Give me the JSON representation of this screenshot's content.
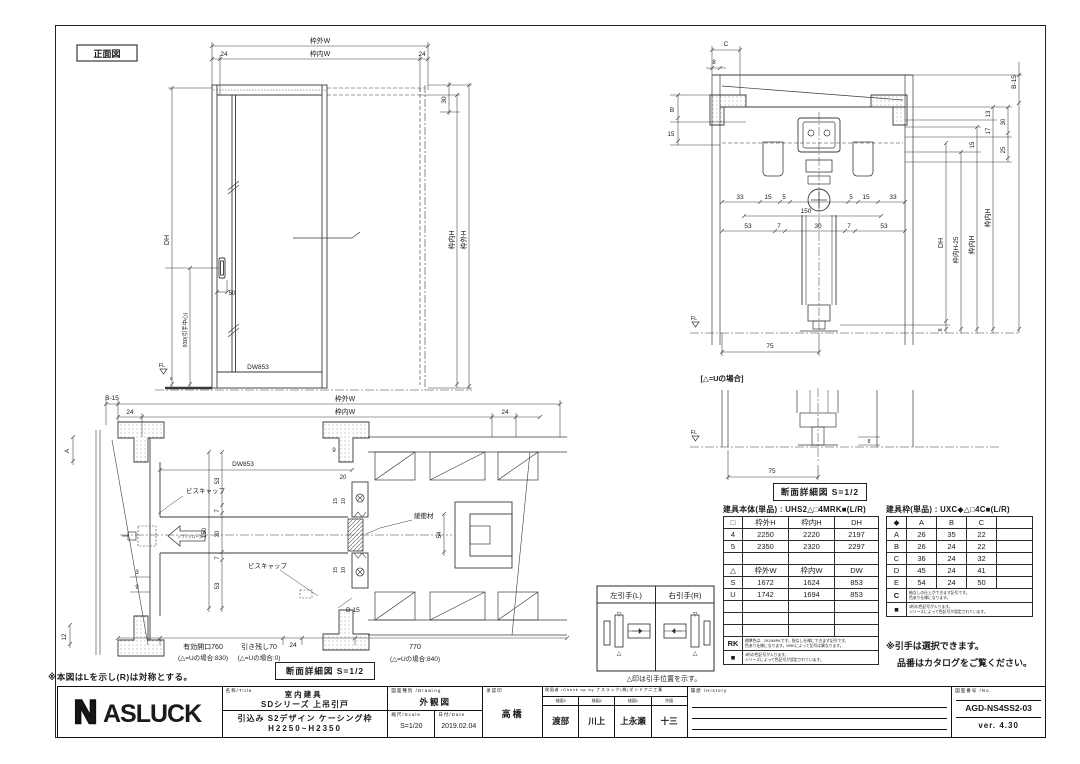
{
  "colors": {
    "line": "#3a3a3a",
    "text": "#1a1a1a",
    "frame": "#222222"
  },
  "front_view": {
    "label": "正面図",
    "dim_outer_w": "枠外W",
    "dim_inner_w": "枠内W",
    "d24_l": "24",
    "d24_r": "24",
    "dh": "DH",
    "handle_center": "930(引手中心)",
    "d50": "50",
    "dw": "DW853",
    "fl": "FL",
    "d8": "8",
    "d30": "30",
    "inner_h": "枠内H",
    "outer_h": "枠外H"
  },
  "plan_view": {
    "b15_l": "B-15",
    "outer_w": "枠外W",
    "inner_w": "枠内W",
    "d24_l": "24",
    "d24_r": "24",
    "d24_b": "24",
    "a": "A",
    "dw": "DW853",
    "d9t": "9",
    "d20": "20",
    "d53a": "53",
    "d7a": "7",
    "d150": "150",
    "d30": "30",
    "d7b": "7",
    "d53b": "53",
    "d15a": "15",
    "d10a": "10",
    "d15b": "15",
    "d10b": "10",
    "d3": "3",
    "d9s": "9",
    "d12": "12",
    "screw_cap": "ビスキャップ",
    "soft_close": "ソフトクローズ",
    "cushion": "緩衝材",
    "d54": "54",
    "b15_r": "B-15",
    "open1": "有効開口760",
    "open1u": "(△=Uの場合:830)",
    "rem": "引き残し70",
    "remu": "(△=Uの場合:0)",
    "d770": "770",
    "d770u": "(△=Uの場合:840)"
  },
  "section_view": {
    "c": "C",
    "d8t": "8",
    "b": "B",
    "d15l": "15",
    "d33a": "33",
    "d15a": "15",
    "d5a": "5",
    "d5b": "5",
    "d15b": "15",
    "d33b": "33",
    "d150": "150",
    "d53a": "53",
    "d7a": "7",
    "d30": "30",
    "d7b": "7",
    "d53b": "53",
    "d13": "13",
    "d30r": "30",
    "d17": "17",
    "d15r": "15",
    "d25": "25",
    "b15": "B-15",
    "dh": "DH",
    "inner_h_25": "枠内H-25",
    "inner_h_a": "枠内H",
    "inner_h_b": "枠内H",
    "d8r": "8",
    "fl": "FL",
    "d75a": "75",
    "u_case": "[△=Uの場合]",
    "fl2": "FL",
    "d75b": "75",
    "d8b": "8"
  },
  "detail_caption": "断面詳細図 S=1/2",
  "handle_box": {
    "left": "左引手(L)",
    "right": "右引手(R)",
    "caption": "△印は引手位置を示す。",
    "marker_down": "▽",
    "marker_up": "△"
  },
  "notes": {
    "mirror": "※本図はLを示し(R)は対称とする。",
    "select1": "※引手は選択できます。",
    "select2": "品番はカタログをご覧ください。"
  },
  "tables": {
    "body": {
      "title": "建具本体(単品) : UHS2△□4MRK■(L/R)",
      "h_header": [
        "□",
        "枠外H",
        "枠内H",
        "DH"
      ],
      "h_rows": [
        [
          "4",
          "2250",
          "2220",
          "2197"
        ],
        [
          "5",
          "2350",
          "2320",
          "2297"
        ]
      ],
      "w_header": [
        "△",
        "枠外W",
        "枠内W",
        "DW"
      ],
      "w_rows": [
        [
          "S",
          "1672",
          "1624",
          "853"
        ],
        [
          "U",
          "1742",
          "1694",
          "853"
        ]
      ],
      "note1_key": "RK",
      "note1a": "標準色は、2919MRKです。指なし仕様にできます記号です。",
      "note1b": "色あり仕様になります。MRKによって記号は異なります。",
      "note2_key": "■",
      "note2a": "3桁の色記号が入ります。",
      "note2b": "シリーズによって色記号が設定されています。"
    },
    "frame": {
      "title": "建具枠(単品) : UXC◆△□4C■(L/R)",
      "header": [
        "◆",
        "A",
        "B",
        "C"
      ],
      "rows": [
        [
          "A",
          "26",
          "35",
          "22"
        ],
        [
          "B",
          "26",
          "24",
          "22"
        ],
        [
          "C",
          "36",
          "24",
          "32"
        ],
        [
          "D",
          "45",
          "24",
          "41"
        ],
        [
          "E",
          "54",
          "24",
          "50"
        ]
      ],
      "note1_key": "C",
      "note1a": "袖なしの仕上ができます記号です。",
      "note1b": "色あり仕様になります。",
      "note2_key": "■",
      "note2a": "3桁の色記号が入ります。",
      "note2b": "シリーズによって色記号が設定されています。"
    }
  },
  "title_block": {
    "logo_n": "N",
    "logo_rest": "ASLUCK",
    "name_label": "名称/Title",
    "name1": "室内建具",
    "name2": "SDシリーズ 上吊引戸",
    "name3": "引込み S2デザイン ケーシング枠",
    "name4": "H2250~H2350",
    "drawing_label": "図面種別 /Drawing",
    "drawing_type": "外観図",
    "scale_label": "縮尺/Scale",
    "scale": "S=1/20",
    "date_label": "日付/Date",
    "date": "2019.02.04",
    "approval_label": "承認印",
    "approval": "高橋",
    "check_label": "検図者 /Check up by ナスラック(株)ダンドア二工業",
    "check_cols": [
      {
        "label": "検図3",
        "value": "渡部"
      },
      {
        "label": "検図2",
        "value": "川上"
      },
      {
        "label": "検図1",
        "value": "上永瀬"
      },
      {
        "label": "作図",
        "value": "十三"
      }
    ],
    "history_label": "履歴 /History",
    "no_label": "図面番号 /No.",
    "drawing_no": "AGD-NS4SS2-03",
    "version": "ver. 4.30"
  }
}
